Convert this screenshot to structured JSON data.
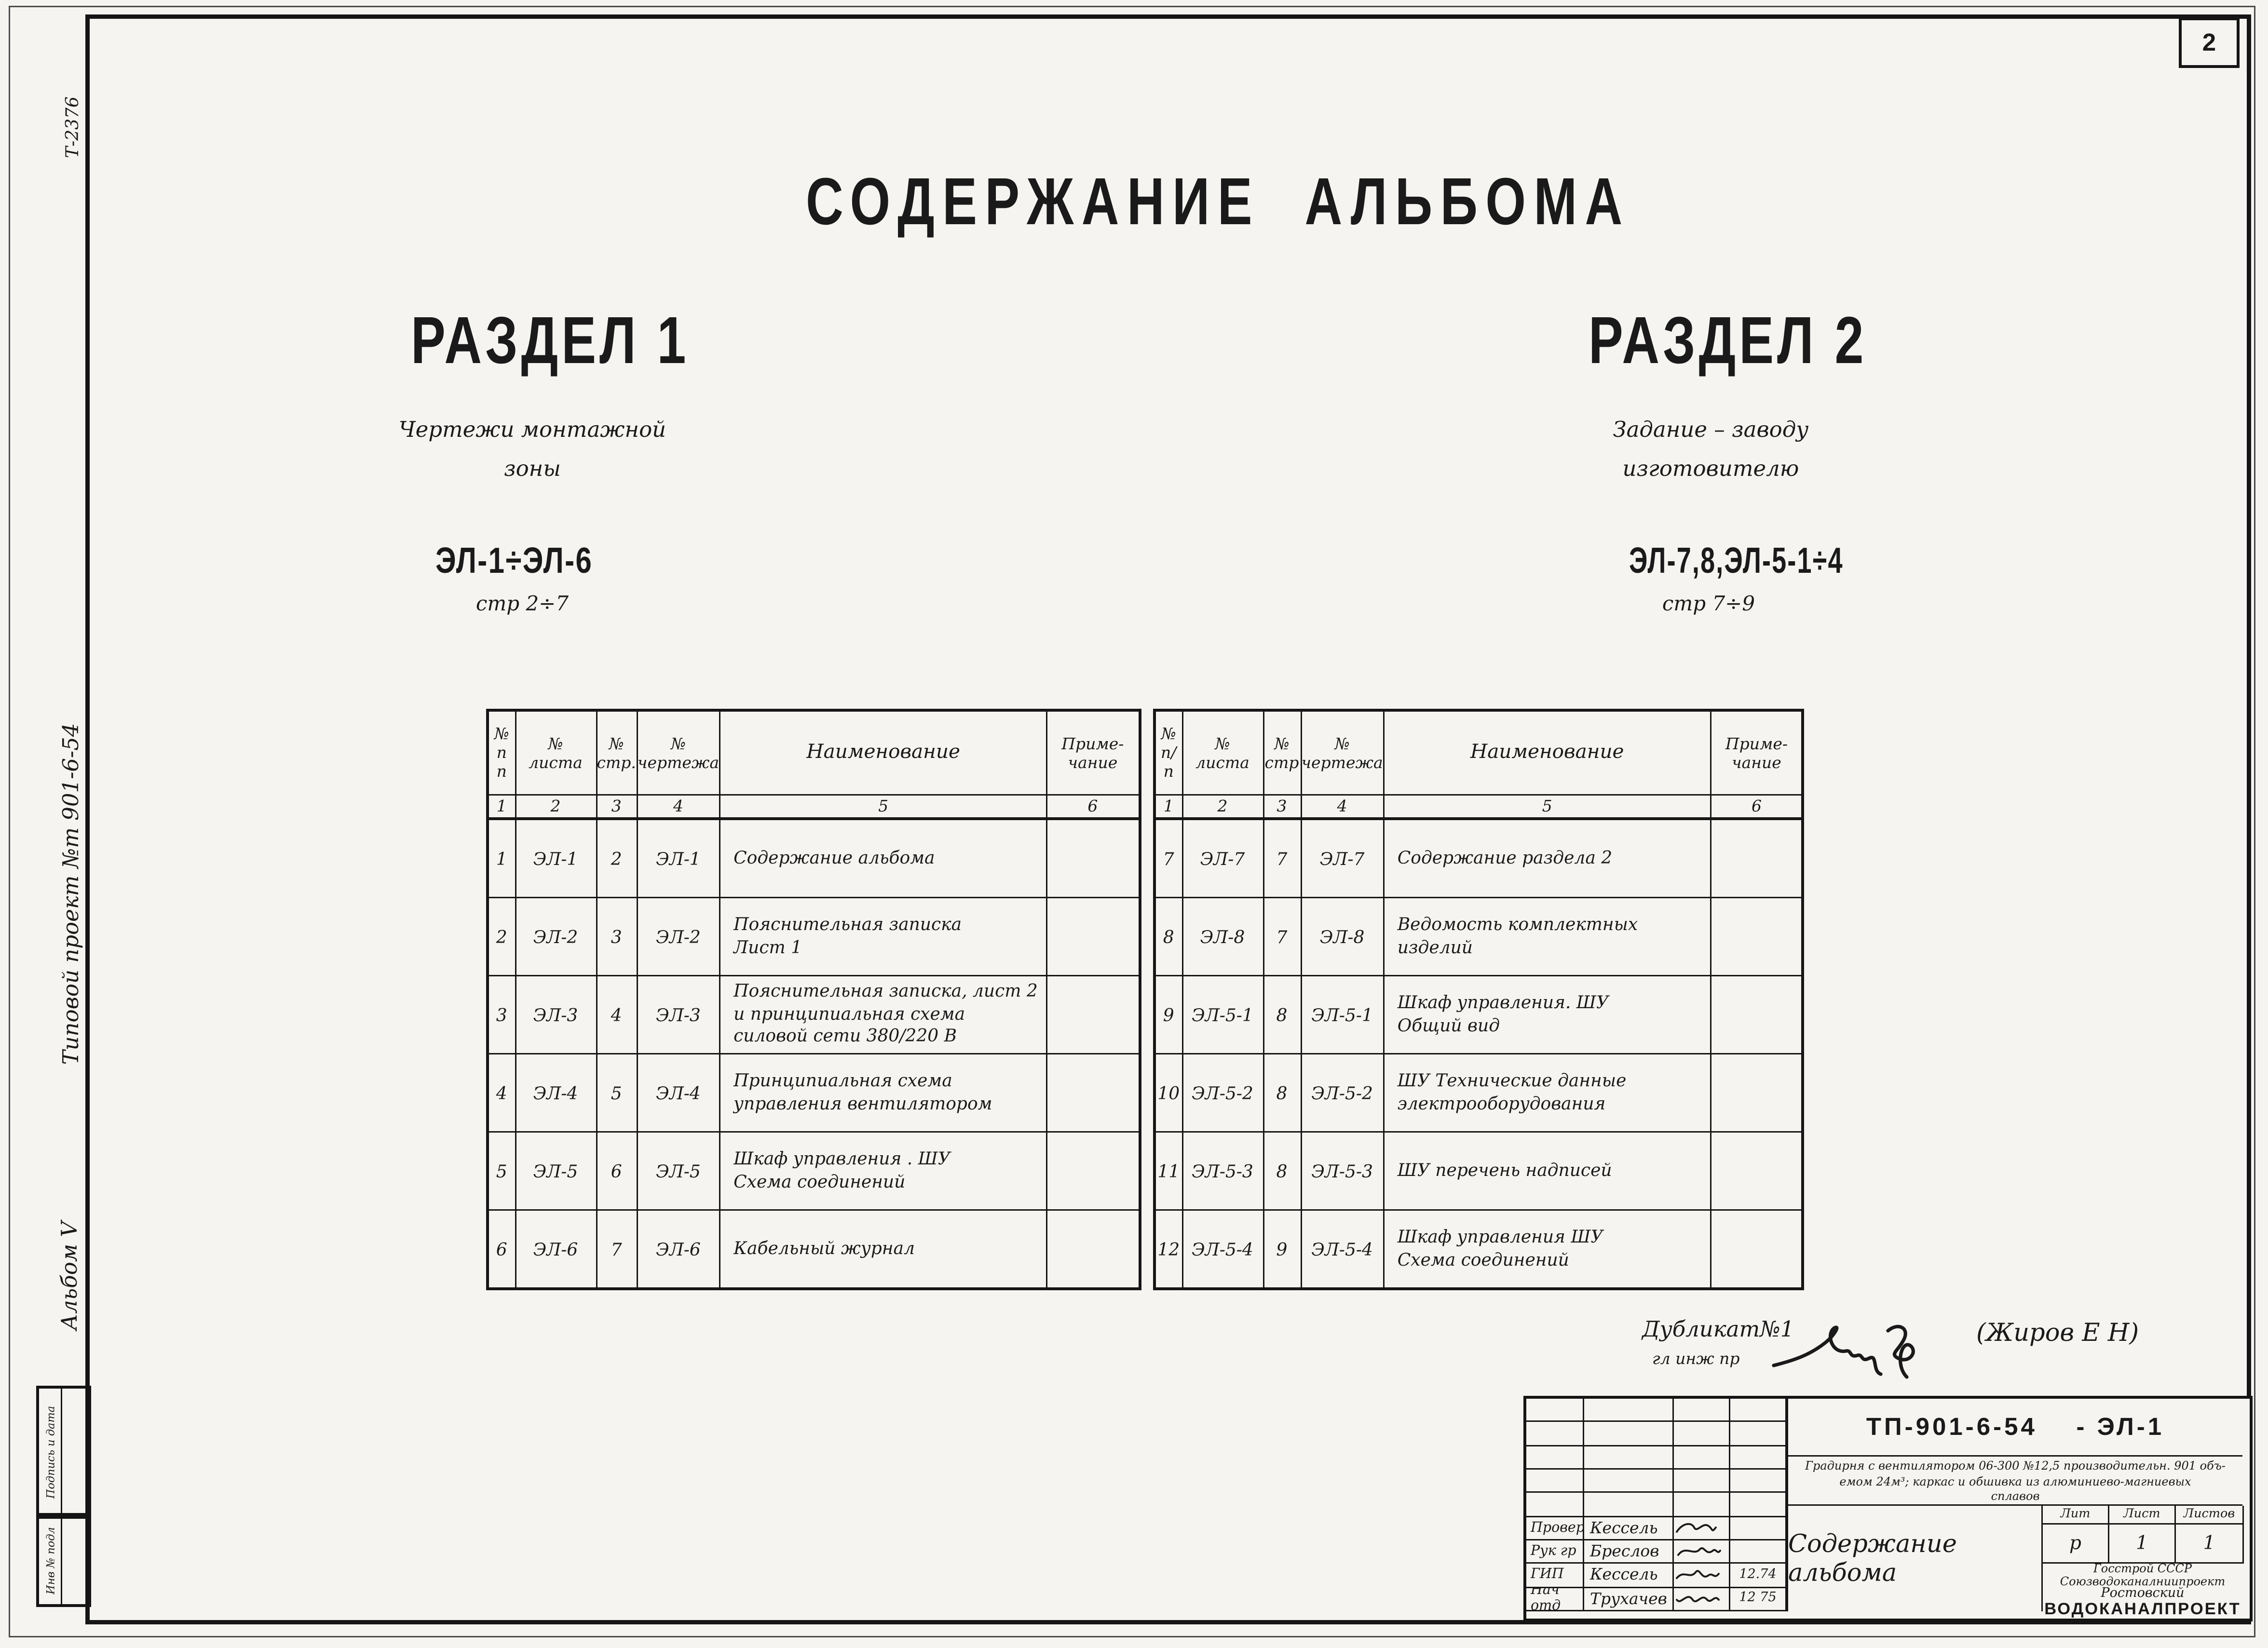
{
  "page_number": "2",
  "margin_notes": {
    "top_code": "Т-2376",
    "project": "Типовой проект №т 901-6-54",
    "album": "Альбом V",
    "stamp_sign_date": "Подпись и дата",
    "stamp_inv": "Инв № подл"
  },
  "title": "СОДЕРЖАНИЕ  АЛЬБОМА",
  "sections": [
    {
      "heading": "РАЗДЕЛ 1",
      "subtitle_lines": [
        "Чертежи  монтажной",
        "зоны"
      ],
      "code": "ЭЛ-1÷ЭЛ-6",
      "pages": "стр 2÷7"
    },
    {
      "heading": "РАЗДЕЛ 2",
      "subtitle_lines": [
        "Задание – заводу",
        "изготовителю"
      ],
      "code": "ЭЛ-7,8,ЭЛ-5-1÷4",
      "pages": "стр 7÷9"
    }
  ],
  "tables": {
    "left": {
      "columns": [
        {
          "lines": [
            "№",
            "п п"
          ]
        },
        {
          "lines": [
            "№",
            "листа"
          ]
        },
        {
          "lines": [
            "№",
            "стр."
          ]
        },
        {
          "lines": [
            "№",
            "чертежа"
          ]
        },
        {
          "lines": [
            "Наименование"
          ]
        },
        {
          "lines": [
            "Приме-",
            "чание"
          ]
        }
      ],
      "numbering": [
        "1",
        "2",
        "3",
        "4",
        "5",
        "6"
      ],
      "rows": [
        {
          "num": "1",
          "sheet": "ЭЛ-1",
          "page": "2",
          "drawing": "ЭЛ-1",
          "name_lines": [
            "Содержание  альбома"
          ],
          "note": ""
        },
        {
          "num": "2",
          "sheet": "ЭЛ-2",
          "page": "3",
          "drawing": "ЭЛ-2",
          "name_lines": [
            "Пояснительная  записка",
            "Лист 1"
          ],
          "note": ""
        },
        {
          "num": "3",
          "sheet": "ЭЛ-3",
          "page": "4",
          "drawing": "ЭЛ-3",
          "name_lines": [
            "Пояснительная  записка, лист 2",
            "и  принципиальная  схема",
            "силовой  сети  380/220 В"
          ],
          "note": ""
        },
        {
          "num": "4",
          "sheet": "ЭЛ-4",
          "page": "5",
          "drawing": "ЭЛ-4",
          "name_lines": [
            "Принципиальная  схема",
            "управления  вентилятором"
          ],
          "note": ""
        },
        {
          "num": "5",
          "sheet": "ЭЛ-5",
          "page": "6",
          "drawing": "ЭЛ-5",
          "name_lines": [
            "Шкаф  управления . ШУ",
            "Схема  соединений"
          ],
          "note": ""
        },
        {
          "num": "6",
          "sheet": "ЭЛ-6",
          "page": "7",
          "drawing": "ЭЛ-6",
          "name_lines": [
            "Кабельный  журнал"
          ],
          "note": ""
        }
      ]
    },
    "right": {
      "columns": [
        {
          "lines": [
            "№",
            "п/п"
          ]
        },
        {
          "lines": [
            "№",
            "листа"
          ]
        },
        {
          "lines": [
            "№",
            "стр"
          ]
        },
        {
          "lines": [
            "№",
            "чертежа"
          ]
        },
        {
          "lines": [
            "Наименование"
          ]
        },
        {
          "lines": [
            "Приме-",
            "чание"
          ]
        }
      ],
      "numbering": [
        "1",
        "2",
        "3",
        "4",
        "5",
        "6"
      ],
      "rows": [
        {
          "num": "7",
          "sheet": "ЭЛ-7",
          "page": "7",
          "drawing": "ЭЛ-7",
          "name_lines": [
            "Содержание  раздела 2"
          ],
          "note": ""
        },
        {
          "num": "8",
          "sheet": "ЭЛ-8",
          "page": "7",
          "drawing": "ЭЛ-8",
          "name_lines": [
            "Ведомость  комплектных  изделий"
          ],
          "note": ""
        },
        {
          "num": "9",
          "sheet": "ЭЛ-5-1",
          "page": "8",
          "drawing": "ЭЛ-5-1",
          "name_lines": [
            "Шкаф  управления. ШУ",
            "Общий  вид"
          ],
          "note": ""
        },
        {
          "num": "10",
          "sheet": "ЭЛ-5-2",
          "page": "8",
          "drawing": "ЭЛ-5-2",
          "name_lines": [
            "ШУ Технические  данные",
            "электрооборудования"
          ],
          "note": ""
        },
        {
          "num": "11",
          "sheet": "ЭЛ-5-3",
          "page": "8",
          "drawing": "ЭЛ-5-3",
          "name_lines": [
            "ШУ  перечень  надписей"
          ],
          "note": ""
        },
        {
          "num": "12",
          "sheet": "ЭЛ-5-4",
          "page": "9",
          "drawing": "ЭЛ-5-4",
          "name_lines": [
            "Шкаф  управления  ШУ",
            "Схема  соединений"
          ],
          "note": ""
        }
      ]
    }
  },
  "annotation": {
    "line1": "Дубликат№1",
    "line2": "гл инж пр",
    "name": "(Жиров Е Н)"
  },
  "title_block": {
    "doc_code": "ТП-901-6-54    - ЭЛ-1",
    "description_lines": [
      "Градирня с вентилятором 06-300 №12,5 производительн. 901 объ-",
      "емом  24м³; каркас и обшивка из алюминиево-магниевых",
      "сплавов"
    ],
    "sheet_title": "Содержание  альбома",
    "signature_rows": [
      {
        "role": "Провер",
        "name": "Кессель",
        "date": ""
      },
      {
        "role": "Рук гр",
        "name": "Бреслов",
        "date": ""
      },
      {
        "role": "ГИП",
        "name": "Кессель",
        "date": "12.74"
      },
      {
        "role": "Нач отд",
        "name": "Трухачев",
        "date": "12 75"
      }
    ],
    "lit_header": [
      "Лит",
      "Лист",
      "Листов"
    ],
    "lit_values": [
      "р",
      "1",
      "1"
    ],
    "org_lines": [
      "Госстрой СССР",
      "Союзводоканалниипроект",
      "Ростовский",
      "ВОДОКАНАЛПРОЕКТ"
    ]
  },
  "colors": {
    "paper": "#f5f4f1",
    "ink": "#1a1a1a"
  }
}
